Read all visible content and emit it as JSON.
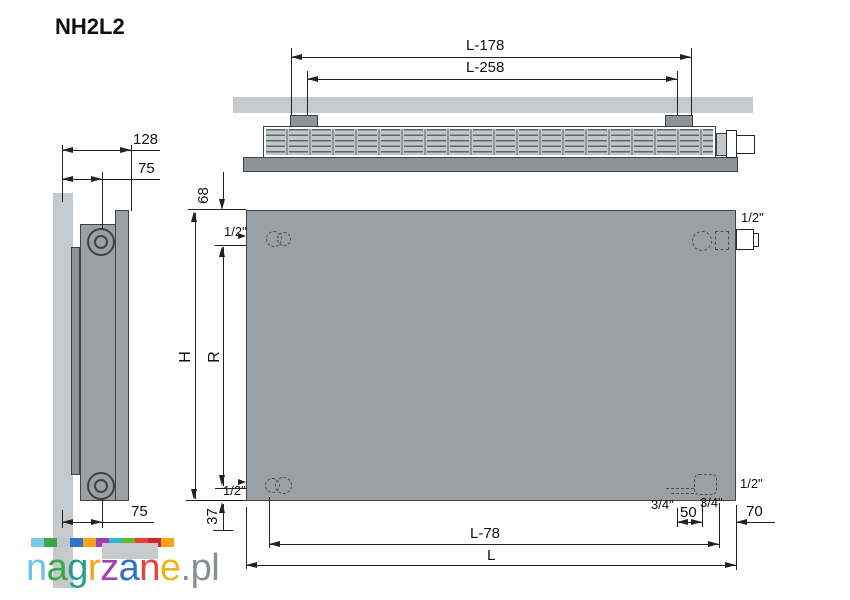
{
  "title": "NH2L2",
  "side_view": {
    "depth": "128",
    "top_center": "75",
    "bottom_center": "75"
  },
  "top_view": {
    "bracket_outer": "L-178",
    "bracket_inner": "L-258"
  },
  "front_view": {
    "top_offset": "68",
    "half_top_left": "1/2\"",
    "height": "H",
    "spacing": "R",
    "half_bottom_left": "1/2\"",
    "bottom_offset": "37",
    "half_top_right": "1/2\"",
    "half_bottom_right": "1/2\"",
    "three_quarter_left": "3/4\"",
    "three_quarter_right": "3/4\"",
    "br_spacing": "50",
    "right_offset": "70",
    "length_minus_78": "L-78",
    "length": "L"
  },
  "logo": {
    "name": "nagrzane.pl",
    "squares": [
      {
        "bg": "#7ec9e8"
      },
      {
        "bg": "#3aa74a"
      },
      {
        "bg": "#c0c5c8"
      },
      {
        "bg": "#2e74c9"
      },
      {
        "bg": "#f6a21c"
      },
      {
        "bg": "#9d3db8"
      },
      {
        "bg": "#2fb9cf"
      },
      {
        "bg": "#6cb52d"
      },
      {
        "bg": "#e8403a"
      },
      {
        "bg": "#d1242f"
      },
      {
        "bg": "#f6a21c"
      }
    ],
    "letters": [
      {
        "char": "n",
        "color": "#69c5ea"
      },
      {
        "char": "a",
        "color": "#3aa74a"
      },
      {
        "char": "g",
        "color": "#2a9d8f"
      },
      {
        "char": "r",
        "color": "#f6a21c"
      },
      {
        "char": "z",
        "color": "#a042b5"
      },
      {
        "char": "a",
        "color": "#2e74c9"
      },
      {
        "char": "n",
        "color": "#e8403a"
      },
      {
        "char": "e",
        "color": "#f0b41f"
      },
      {
        "char": ".",
        "color": "#8a8f93"
      },
      {
        "char": "p",
        "color": "#8a8f93"
      },
      {
        "char": "l",
        "color": "#8a8f93"
      }
    ]
  },
  "colors": {
    "wall": "#c6cacc",
    "panel": "#9aa0a5",
    "panel_dark": "#8e9397",
    "outline": "#3f4347",
    "dimension_line": "#222222"
  }
}
